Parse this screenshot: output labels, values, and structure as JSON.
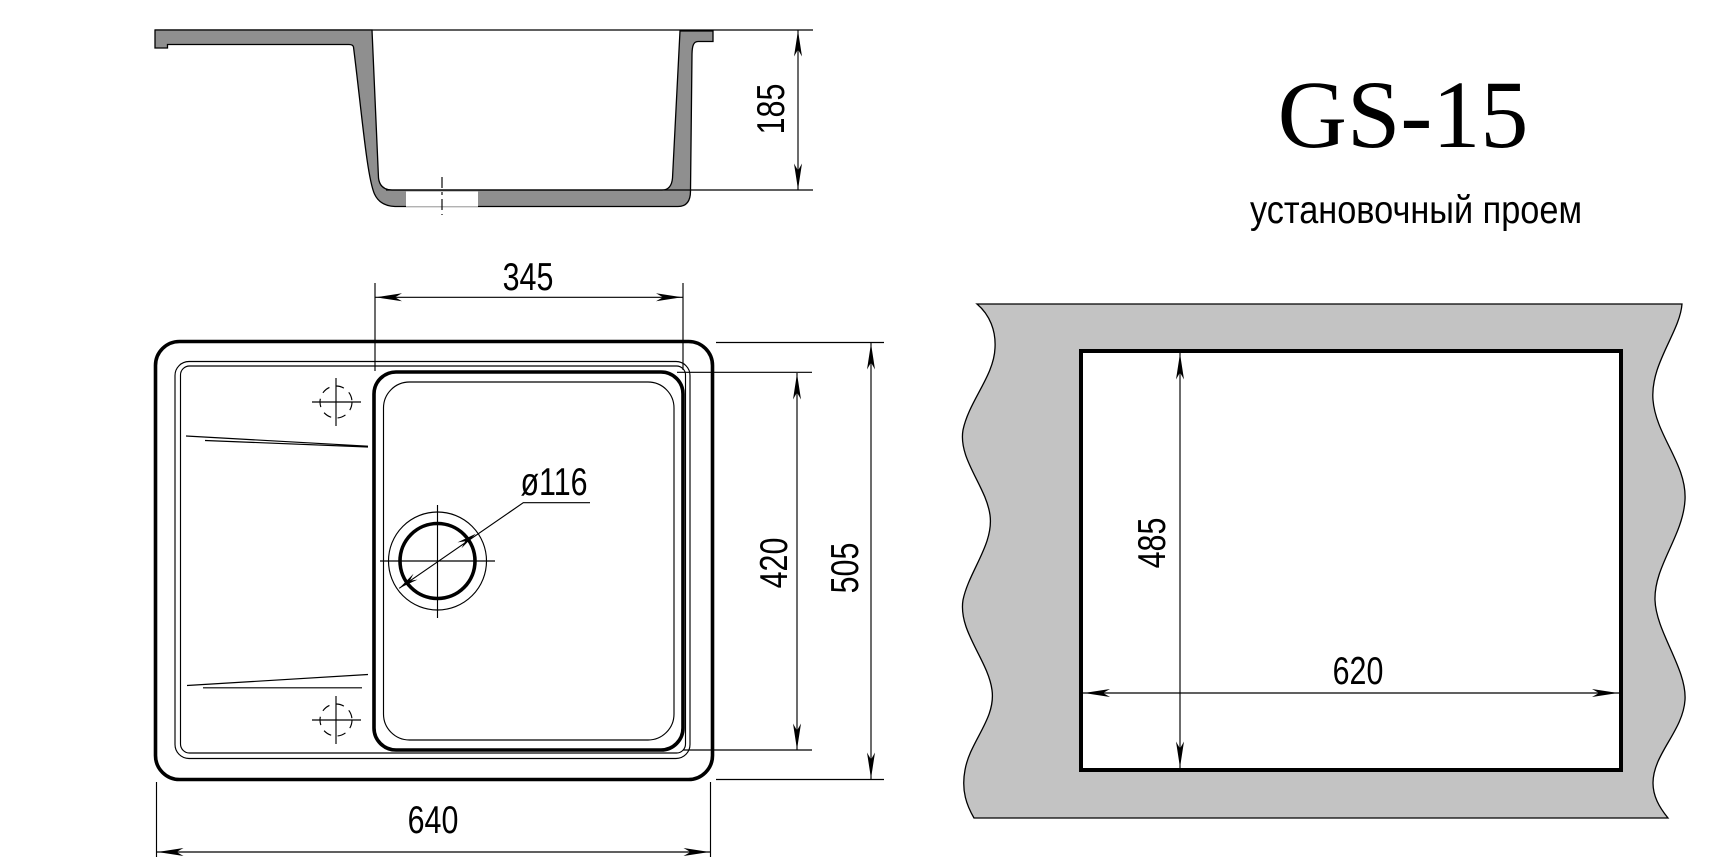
{
  "document": {
    "title": "GS-15",
    "subtitle": "установочный проем"
  },
  "dims": {
    "section_height": "185",
    "bowl_width": "345",
    "overall_width": "640",
    "bowl_depth": "420",
    "overall_depth": "505",
    "drain_diameter": "ø116",
    "cutout_height": "485",
    "cutout_width": "620"
  },
  "colors": {
    "section_fill": "#8f8f8f",
    "countertop_fill": "#c3c3c3",
    "background": "#ffffff",
    "line": "#000000"
  }
}
